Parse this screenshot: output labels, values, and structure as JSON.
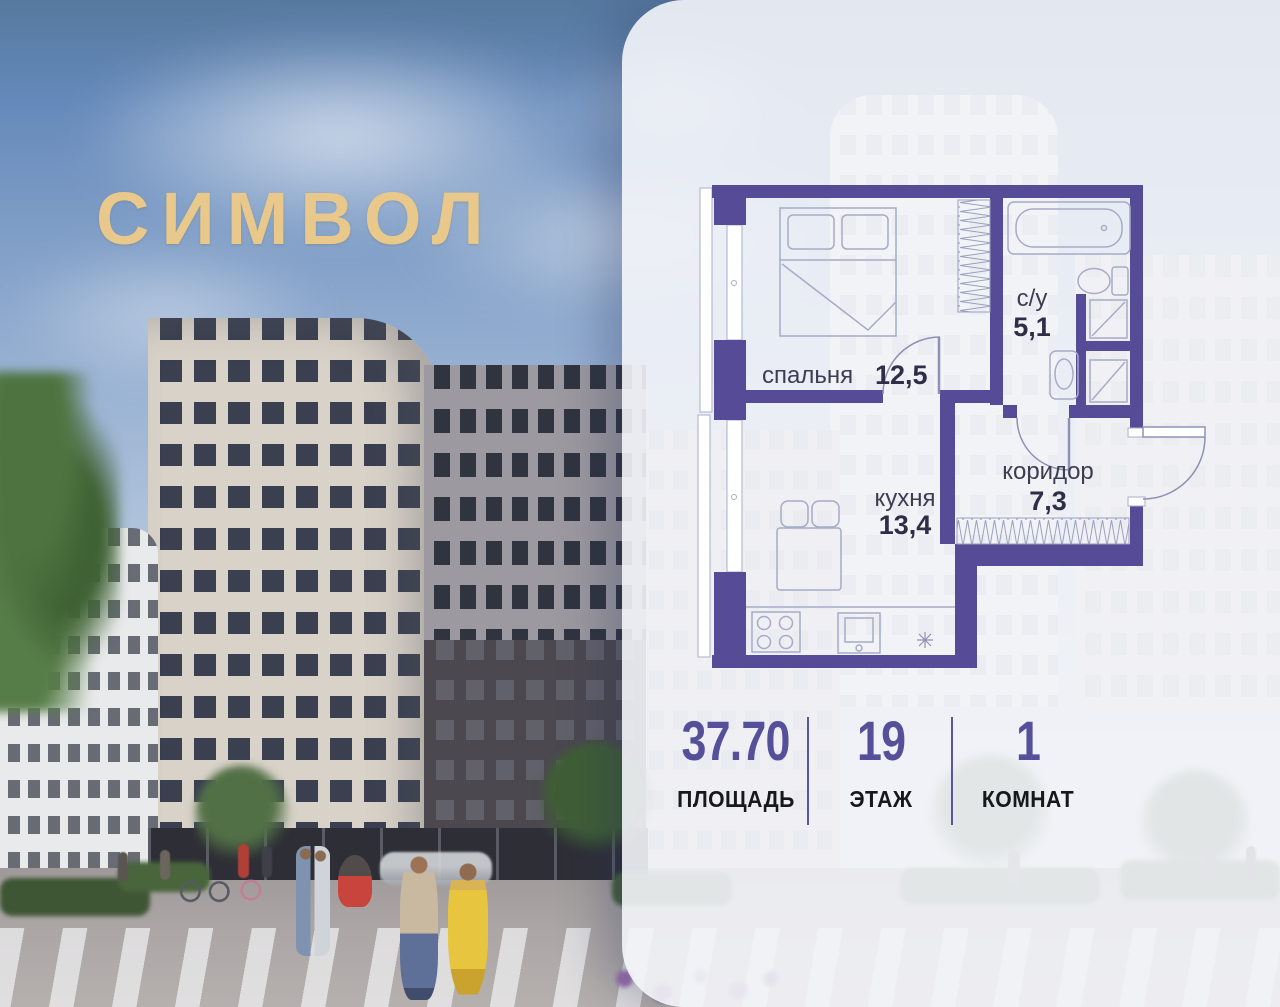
{
  "logo": {
    "text": "СИМВОЛ"
  },
  "plan": {
    "rooms": [
      {
        "id": "bedroom",
        "name": "спальня",
        "area": "12,5"
      },
      {
        "id": "bathroom",
        "name": "с/у",
        "area": "5,1"
      },
      {
        "id": "kitchen",
        "name": "кухня",
        "area": "13,4"
      },
      {
        "id": "corridor",
        "name": "коридор",
        "area": "7,3"
      }
    ]
  },
  "stats": [
    {
      "value": "37.70",
      "label": "ПЛОЩАДЬ"
    },
    {
      "value": "19",
      "label": "ЭТАЖ"
    },
    {
      "value": "1",
      "label": "КОМНАТ"
    }
  ],
  "colors": {
    "accent": "#56509b",
    "wall": "#554b96",
    "logo_gold": "#e9c88c"
  }
}
